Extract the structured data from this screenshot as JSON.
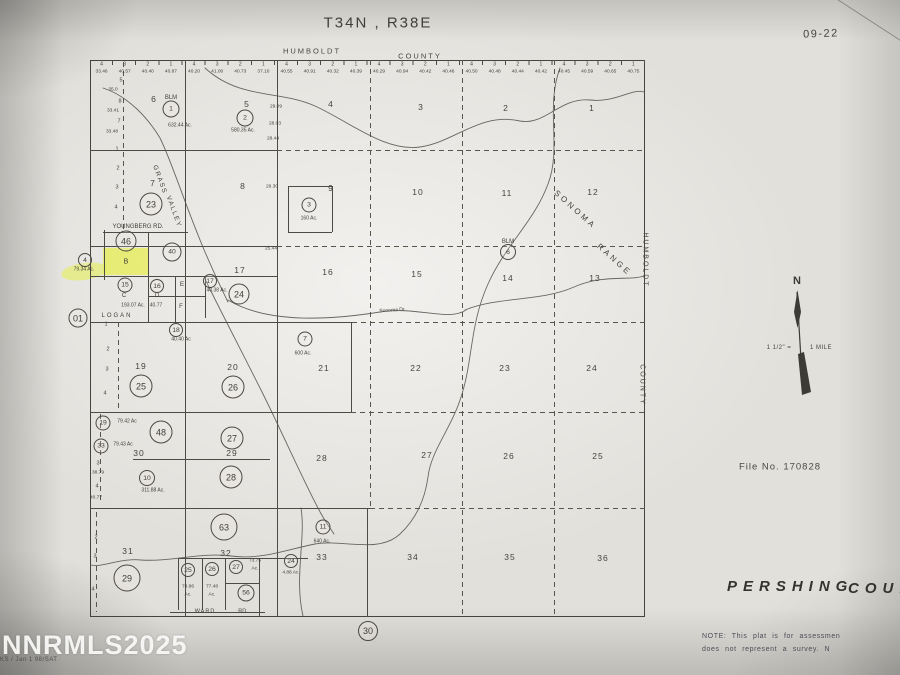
{
  "title": "T34N , R38E",
  "page_code": "09-22",
  "county_top_left": "HUMBOLDT",
  "county_top_right": "COUNTY",
  "right_border": {
    "word1": "HUMBOLDT",
    "word2": "COUNTY"
  },
  "file_no": "File No. 170828",
  "pershing": {
    "word1": "PERSHING",
    "word2": "COUN"
  },
  "note": {
    "line1": "NOTE: This plat is for assessmen",
    "line2": "does not represent a survey. N"
  },
  "north": {
    "letter": "N",
    "scale_left": "1 1/2\" =",
    "scale_right": "1 MILE"
  },
  "watermark": {
    "main": "NNRMLS2025",
    "sub": "KS / Jan 1 98/SAT"
  },
  "highlight_color": "#e6ee5a",
  "sheet_refs": [
    {
      "n": "01",
      "x": 78,
      "y": 318,
      "d": 17
    },
    {
      "n": "30",
      "x": 368,
      "y": 631,
      "d": 18
    }
  ],
  "sections": [
    {
      "n": "6",
      "x": 154,
      "y": 99
    },
    {
      "n": "5",
      "x": 247,
      "y": 104
    },
    {
      "n": "4",
      "x": 331,
      "y": 104
    },
    {
      "n": "3",
      "x": 421,
      "y": 107
    },
    {
      "n": "2",
      "x": 506,
      "y": 108
    },
    {
      "n": "1",
      "x": 592,
      "y": 108
    },
    {
      "n": "7",
      "x": 153,
      "y": 183
    },
    {
      "n": "8",
      "x": 243,
      "y": 186
    },
    {
      "n": "9",
      "x": 331,
      "y": 188
    },
    {
      "n": "10",
      "x": 418,
      "y": 192
    },
    {
      "n": "11",
      "x": 507,
      "y": 193
    },
    {
      "n": "12",
      "x": 593,
      "y": 192
    },
    {
      "n": "17",
      "x": 240,
      "y": 270
    },
    {
      "n": "16",
      "x": 328,
      "y": 272
    },
    {
      "n": "15",
      "x": 417,
      "y": 274
    },
    {
      "n": "14",
      "x": 508,
      "y": 278
    },
    {
      "n": "13",
      "x": 595,
      "y": 278
    },
    {
      "n": "19",
      "x": 141,
      "y": 366
    },
    {
      "n": "20",
      "x": 233,
      "y": 367
    },
    {
      "n": "21",
      "x": 324,
      "y": 368
    },
    {
      "n": "22",
      "x": 416,
      "y": 368
    },
    {
      "n": "23",
      "x": 505,
      "y": 368
    },
    {
      "n": "24",
      "x": 592,
      "y": 368
    },
    {
      "n": "30",
      "x": 139,
      "y": 453
    },
    {
      "n": "29",
      "x": 232,
      "y": 453
    },
    {
      "n": "28",
      "x": 322,
      "y": 458
    },
    {
      "n": "27",
      "x": 427,
      "y": 455
    },
    {
      "n": "26",
      "x": 509,
      "y": 456
    },
    {
      "n": "25",
      "x": 598,
      "y": 456
    },
    {
      "n": "31",
      "x": 128,
      "y": 551
    },
    {
      "n": "32",
      "x": 226,
      "y": 553
    },
    {
      "n": "33",
      "x": 322,
      "y": 557
    },
    {
      "n": "34",
      "x": 413,
      "y": 557
    },
    {
      "n": "35",
      "x": 510,
      "y": 557
    },
    {
      "n": "36",
      "x": 603,
      "y": 558
    }
  ],
  "circles": [
    {
      "n": "1",
      "x": 171,
      "y": 109,
      "d": 15
    },
    {
      "n": "2",
      "x": 245,
      "y": 118,
      "d": 15
    },
    {
      "n": "3",
      "x": 309,
      "y": 205,
      "d": 13
    },
    {
      "n": "23",
      "x": 151,
      "y": 204,
      "d": 21
    },
    {
      "n": "46",
      "x": 126,
      "y": 241,
      "d": 19
    },
    {
      "n": "40",
      "x": 172,
      "y": 252,
      "d": 17
    },
    {
      "n": "4",
      "x": 85,
      "y": 260,
      "d": 12
    },
    {
      "n": "15",
      "x": 125,
      "y": 285,
      "d": 13
    },
    {
      "n": "16",
      "x": 157,
      "y": 286,
      "d": 12
    },
    {
      "n": "17",
      "x": 210,
      "y": 281,
      "d": 12
    },
    {
      "n": "24",
      "x": 239,
      "y": 294,
      "d": 19
    },
    {
      "n": "6",
      "x": 508,
      "y": 252,
      "d": 14
    },
    {
      "n": "18",
      "x": 176,
      "y": 330,
      "d": 12
    },
    {
      "n": "7",
      "x": 305,
      "y": 339,
      "d": 13
    },
    {
      "n": "25",
      "x": 141,
      "y": 386,
      "d": 21
    },
    {
      "n": "26",
      "x": 233,
      "y": 387,
      "d": 21
    },
    {
      "n": "19",
      "x": 103,
      "y": 423,
      "d": 13
    },
    {
      "n": "33",
      "x": 101,
      "y": 446,
      "d": 13
    },
    {
      "n": "48",
      "x": 161,
      "y": 432,
      "d": 21
    },
    {
      "n": "27",
      "x": 232,
      "y": 438,
      "d": 21
    },
    {
      "n": "10",
      "x": 147,
      "y": 478,
      "d": 14
    },
    {
      "n": "28",
      "x": 231,
      "y": 477,
      "d": 21
    },
    {
      "n": "63",
      "x": 224,
      "y": 527,
      "d": 25
    },
    {
      "n": "11",
      "x": 323,
      "y": 527,
      "d": 13
    },
    {
      "n": "29",
      "x": 127,
      "y": 578,
      "d": 25
    },
    {
      "n": "25",
      "x": 188,
      "y": 570,
      "d": 12
    },
    {
      "n": "26",
      "x": 212,
      "y": 569,
      "d": 12
    },
    {
      "n": "27",
      "x": 236,
      "y": 567,
      "d": 12
    },
    {
      "n": "56",
      "x": 246,
      "y": 593,
      "d": 15
    },
    {
      "n": "24",
      "x": 291,
      "y": 561,
      "d": 12
    }
  ],
  "annotations": [
    {
      "t": "BLM",
      "x": 171,
      "y": 98,
      "fs": 6,
      "name": "blm-label"
    },
    {
      "t": "632.44 Ac.",
      "x": 180,
      "y": 126,
      "fs": 5,
      "name": "acreage-label"
    },
    {
      "t": "580.35 Ac.",
      "x": 243,
      "y": 131,
      "fs": 5,
      "name": "acreage-label"
    },
    {
      "t": "160 Ac.",
      "x": 309,
      "y": 219,
      "fs": 5,
      "name": "acreage-label"
    },
    {
      "t": "GRASS",
      "x": 159,
      "y": 180,
      "fs": 6.5,
      "rot": 70,
      "ls": 1.5,
      "name": "road-label-grass-valley"
    },
    {
      "t": "VALLEY",
      "x": 173,
      "y": 212,
      "fs": 6.5,
      "rot": 70,
      "ls": 1.5,
      "name": "road-label-grass-valley"
    },
    {
      "t": "YOUNGBERG  RD.",
      "x": 138,
      "y": 227,
      "fs": 6,
      "name": "road-label-youngberg"
    },
    {
      "t": "B",
      "x": 126,
      "y": 262,
      "fs": 7,
      "name": "parcel-letter"
    },
    {
      "t": "79.34 Ac.",
      "x": 84,
      "y": 270,
      "fs": 5,
      "name": "acreage-label"
    },
    {
      "t": "C",
      "x": 124,
      "y": 296,
      "fs": 6,
      "name": "parcel-letter"
    },
    {
      "t": "193.07 Ac.",
      "x": 133,
      "y": 306,
      "fs": 5,
      "name": "acreage-label"
    },
    {
      "t": "D",
      "x": 157,
      "y": 296,
      "fs": 6,
      "name": "parcel-letter"
    },
    {
      "t": "40.77",
      "x": 156,
      "y": 306,
      "fs": 5,
      "name": "acreage-label"
    },
    {
      "t": "E",
      "x": 182,
      "y": 285,
      "fs": 6.5,
      "name": "parcel-letter"
    },
    {
      "t": "40.38 Ac.",
      "x": 217,
      "y": 291,
      "fs": 5,
      "name": "acreage-label"
    },
    {
      "t": "F",
      "x": 181,
      "y": 307,
      "fs": 6,
      "name": "parcel-letter"
    },
    {
      "t": "LOGAN",
      "x": 117,
      "y": 316,
      "fs": 6,
      "ls": 2,
      "name": "road-label-logan"
    },
    {
      "t": "40.40 Ac",
      "x": 181,
      "y": 340,
      "fs": 5,
      "name": "acreage-label"
    },
    {
      "t": "600 Ac.",
      "x": 303,
      "y": 354,
      "fs": 5,
      "name": "acreage-label"
    },
    {
      "t": "BLM",
      "x": 508,
      "y": 242,
      "fs": 6,
      "name": "blm-label"
    },
    {
      "t": "SONOMA",
      "x": 575,
      "y": 210,
      "fs": 8,
      "rot": 42,
      "ls": 3,
      "name": "range-label"
    },
    {
      "t": "RANGE",
      "x": 614,
      "y": 260,
      "fs": 8,
      "rot": 42,
      "ls": 3,
      "name": "range-label"
    },
    {
      "t": "Sonoma Dr",
      "x": 392,
      "y": 311,
      "fs": 5,
      "rot": -4,
      "name": "road-label-sonoma"
    },
    {
      "t": "79.42 Ac",
      "x": 127,
      "y": 422,
      "fs": 5,
      "name": "acreage-label"
    },
    {
      "t": "79.43 Ac",
      "x": 123,
      "y": 445,
      "fs": 5,
      "name": "acreage-label"
    },
    {
      "t": "311.88 Ac.",
      "x": 153,
      "y": 491,
      "fs": 5,
      "name": "acreage-label"
    },
    {
      "t": "640 Ac.",
      "x": 322,
      "y": 542,
      "fs": 5,
      "name": "acreage-label"
    },
    {
      "t": "74.86",
      "x": 188,
      "y": 588,
      "fs": 4.8,
      "name": "acreage-label"
    },
    {
      "t": "Ac.",
      "x": 188,
      "y": 596,
      "fs": 4.8,
      "name": "acreage-label"
    },
    {
      "t": "77.48",
      "x": 212,
      "y": 588,
      "fs": 4.8,
      "name": "acreage-label"
    },
    {
      "t": "Ac.",
      "x": 212,
      "y": 596,
      "fs": 4.8,
      "name": "acreage-label"
    },
    {
      "t": "73.75",
      "x": 255,
      "y": 562,
      "fs": 4.8,
      "name": "acreage-label"
    },
    {
      "t": "Ac.",
      "x": 255,
      "y": 570,
      "fs": 4.8,
      "name": "acreage-label"
    },
    {
      "t": "4.88 Ac.",
      "x": 291,
      "y": 574,
      "fs": 4.8,
      "name": "acreage-label"
    },
    {
      "t": "WARD",
      "x": 205,
      "y": 612,
      "fs": 5.5,
      "ls": 1,
      "name": "road-label-ward"
    },
    {
      "t": "RD.",
      "x": 243,
      "y": 612,
      "fs": 5.5,
      "name": "road-label-ward"
    },
    {
      "t": "5",
      "x": 121,
      "y": 81,
      "fs": 5.5,
      "name": "lot-number"
    },
    {
      "t": "35.0",
      "x": 113,
      "y": 91,
      "fs": 4.8,
      "name": "lot-acreage"
    },
    {
      "t": "8",
      "x": 120,
      "y": 102,
      "fs": 5.5,
      "name": "lot-number"
    },
    {
      "t": "33.41",
      "x": 113,
      "y": 112,
      "fs": 4.8,
      "name": "lot-acreage"
    },
    {
      "t": "7",
      "x": 119,
      "y": 122,
      "fs": 5.5,
      "name": "lot-number"
    },
    {
      "t": "33.48",
      "x": 112,
      "y": 133,
      "fs": 4.8,
      "name": "lot-acreage"
    },
    {
      "t": "1",
      "x": 117,
      "y": 150,
      "fs": 5.5,
      "name": "lot-number"
    },
    {
      "t": "2",
      "x": 118,
      "y": 169,
      "fs": 5.5,
      "name": "lot-number"
    },
    {
      "t": "3",
      "x": 117,
      "y": 188,
      "fs": 5.5,
      "name": "lot-number"
    },
    {
      "t": "4",
      "x": 116,
      "y": 208,
      "fs": 5.5,
      "name": "lot-number"
    },
    {
      "t": "1",
      "x": 106,
      "y": 325,
      "fs": 5.5,
      "name": "lot-number"
    },
    {
      "t": "2",
      "x": 108,
      "y": 350,
      "fs": 5.5,
      "name": "lot-number"
    },
    {
      "t": "3",
      "x": 107,
      "y": 370,
      "fs": 5.5,
      "name": "lot-number"
    },
    {
      "t": "4",
      "x": 105,
      "y": 394,
      "fs": 5.5,
      "name": "lot-number"
    },
    {
      "t": "3",
      "x": 98,
      "y": 464,
      "fs": 5.5,
      "name": "lot-number"
    },
    {
      "t": "38.79",
      "x": 98,
      "y": 474,
      "fs": 4.8,
      "name": "lot-acreage"
    },
    {
      "t": "4",
      "x": 97,
      "y": 487,
      "fs": 5.5,
      "name": "lot-number"
    },
    {
      "t": "40.77",
      "x": 96,
      "y": 499,
      "fs": 4.8,
      "name": "lot-acreage"
    },
    {
      "t": "2",
      "x": 96,
      "y": 538,
      "fs": 5.5,
      "name": "lot-number"
    },
    {
      "t": "3",
      "x": 95,
      "y": 557,
      "fs": 5.5,
      "name": "lot-number"
    },
    {
      "t": "4",
      "x": 93,
      "y": 590,
      "fs": 5.5,
      "name": "lot-number"
    },
    {
      "t": "29.09",
      "x": 276,
      "y": 108,
      "fs": 4.8,
      "name": "lot-acreage"
    },
    {
      "t": "28.03",
      "x": 275,
      "y": 125,
      "fs": 4.8,
      "name": "lot-acreage"
    },
    {
      "t": "28.44",
      "x": 273,
      "y": 140,
      "fs": 4.8,
      "name": "lot-acreage"
    },
    {
      "t": "29.30",
      "x": 272,
      "y": 188,
      "fs": 4.8,
      "name": "lot-acreage"
    },
    {
      "t": "25.44",
      "x": 271,
      "y": 250,
      "fs": 4.8,
      "name": "lot-acreage"
    }
  ],
  "top_strip": {
    "ticks": [
      "4",
      "3",
      "2",
      "1"
    ],
    "acres": [
      [
        "33.46",
        "40.57",
        "40.40",
        "40.87"
      ],
      [
        "40.20",
        "41.00",
        "40.73",
        "37.10"
      ],
      [
        "40.55",
        "40.91",
        "40.32",
        "40.39"
      ],
      [
        "40.29",
        "40.94",
        "40.42",
        "40.46"
      ],
      [
        "40.50",
        "40.48",
        "40.44",
        "40.42"
      ],
      [
        "40.45",
        "40.59",
        "40.65",
        "40.75"
      ]
    ]
  }
}
